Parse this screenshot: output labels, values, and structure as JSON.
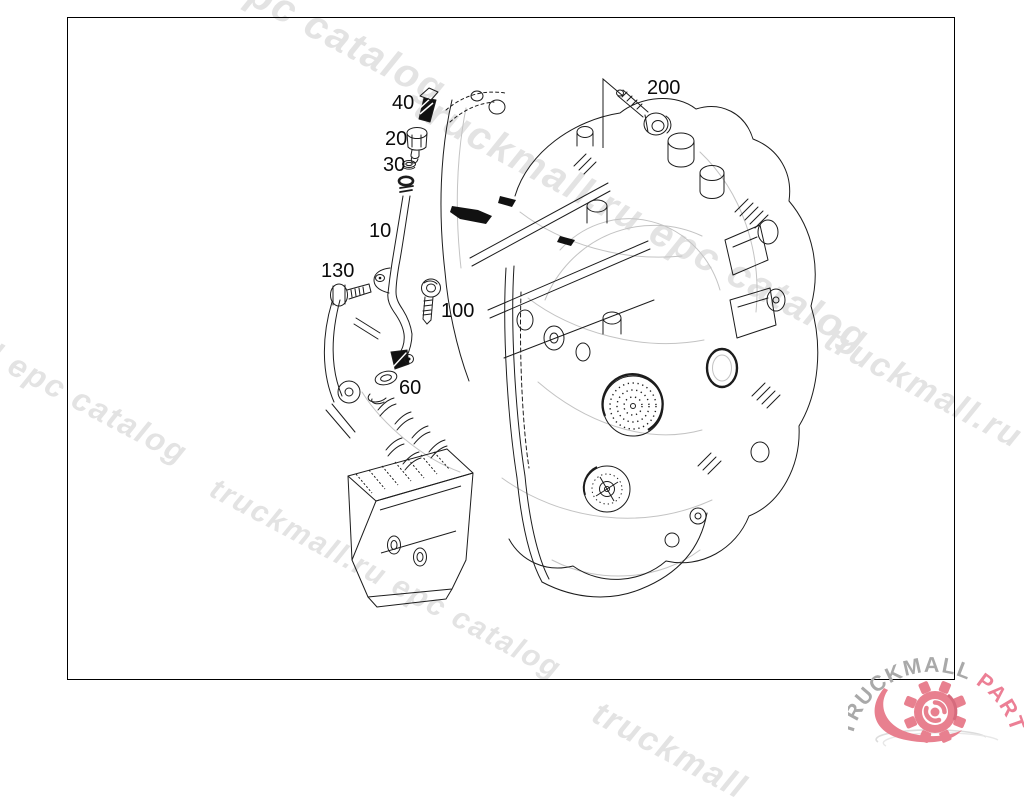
{
  "diagram": {
    "callouts": [
      {
        "label": "40"
      },
      {
        "label": "20"
      },
      {
        "label": "30"
      },
      {
        "label": "10"
      },
      {
        "label": "130"
      },
      {
        "label": "100"
      },
      {
        "label": "60"
      },
      {
        "label": "200"
      }
    ]
  },
  "watermarks": [
    {
      "text": "epc catalog"
    },
    {
      "text": "l epc catalog"
    },
    {
      "text": "truckmall.ru epc catalog"
    },
    {
      "text": "truckmall.ru epc"
    },
    {
      "text": "truckmall.ru epc catalog"
    },
    {
      "text": "truckmall"
    }
  ],
  "logo": {
    "text_primary": "TRUCKMALL",
    "text_accent": "PARTS"
  },
  "colors": {
    "background": "#ffffff",
    "line": "#1c1c1c",
    "watermark": "#e3e3e3",
    "border": "#000000",
    "logo_gray": "#a9a9a9",
    "logo_pink": "#e8808f"
  }
}
